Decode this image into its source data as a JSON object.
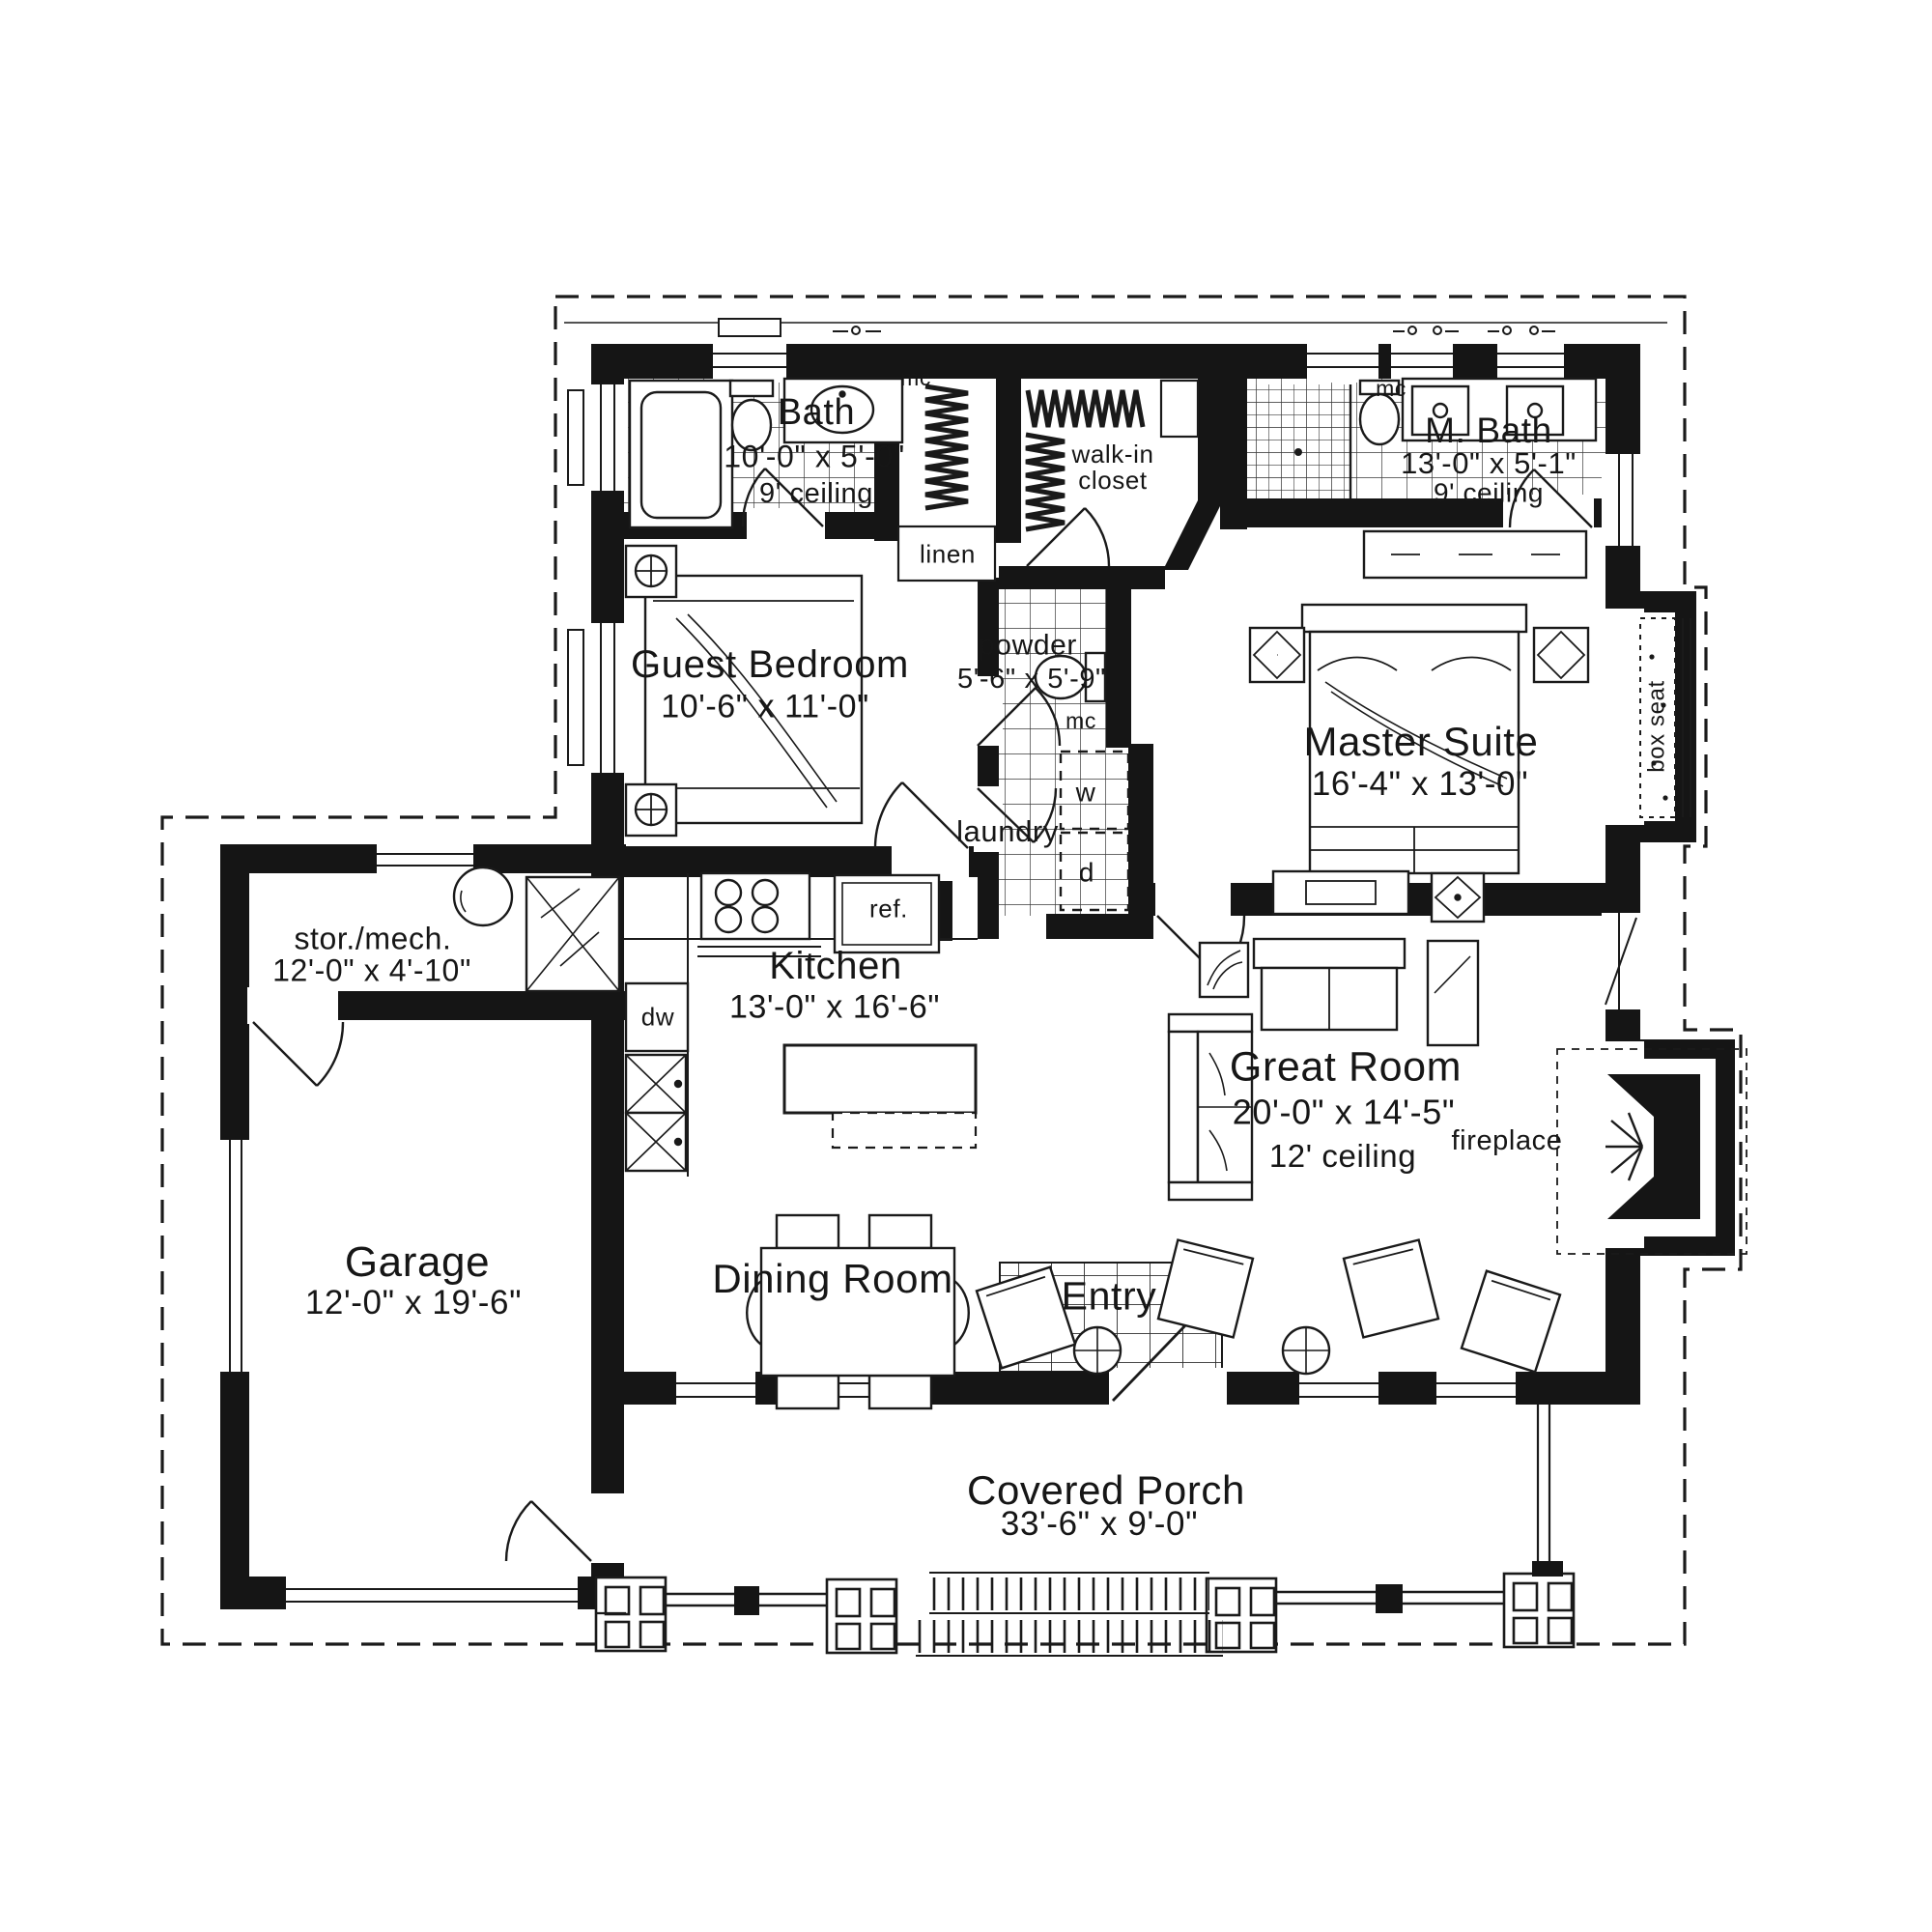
{
  "sheet": {
    "background": "#ffffff",
    "ink": "#1a1a1a"
  },
  "rooms": {
    "bath": {
      "name": "Bath",
      "dims": "10'-0\" x 5'-0\"",
      "ceiling": "9' ceiling"
    },
    "guest_bedroom": {
      "name": "Guest Bedroom",
      "dims": "10'-6\" x 11'-0\""
    },
    "walk_in_closet": {
      "name": "walk-in closet"
    },
    "master_bath": {
      "name": "M. Bath",
      "dims": "13'-0\" x 5'-1\"",
      "ceiling": "9' ceiling"
    },
    "powder": {
      "name": "powder",
      "dims": "5'-6\" x 5'-9\""
    },
    "laundry": {
      "name": "laundry"
    },
    "master_suite": {
      "name": "Master Suite",
      "dims": "16'-4\" x 13'-0\""
    },
    "storage_mech": {
      "name": "stor./mech.",
      "dims": "12'-0\" x 4'-10\""
    },
    "kitchen": {
      "name": "Kitchen",
      "dims": "13'-0\" x 16'-6\""
    },
    "great_room": {
      "name": "Great Room",
      "dims": "20'-0\" x 14'-5\"",
      "ceiling": "12' ceiling"
    },
    "garage": {
      "name": "Garage",
      "dims": "12'-0\" x 19'-6\""
    },
    "dining_room": {
      "name": "Dining Room"
    },
    "entry": {
      "name": "Entry"
    },
    "covered_porch": {
      "name": "Covered Porch",
      "dims": "33'-6\" x 9'-0\""
    }
  },
  "fixtures": {
    "linen": "linen",
    "box_seat": "box seat",
    "fireplace": "fireplace",
    "refrigerator": "ref.",
    "dishwasher": "dw",
    "washer": "w",
    "dryer": "d",
    "medicine_cabinet": "mc"
  }
}
